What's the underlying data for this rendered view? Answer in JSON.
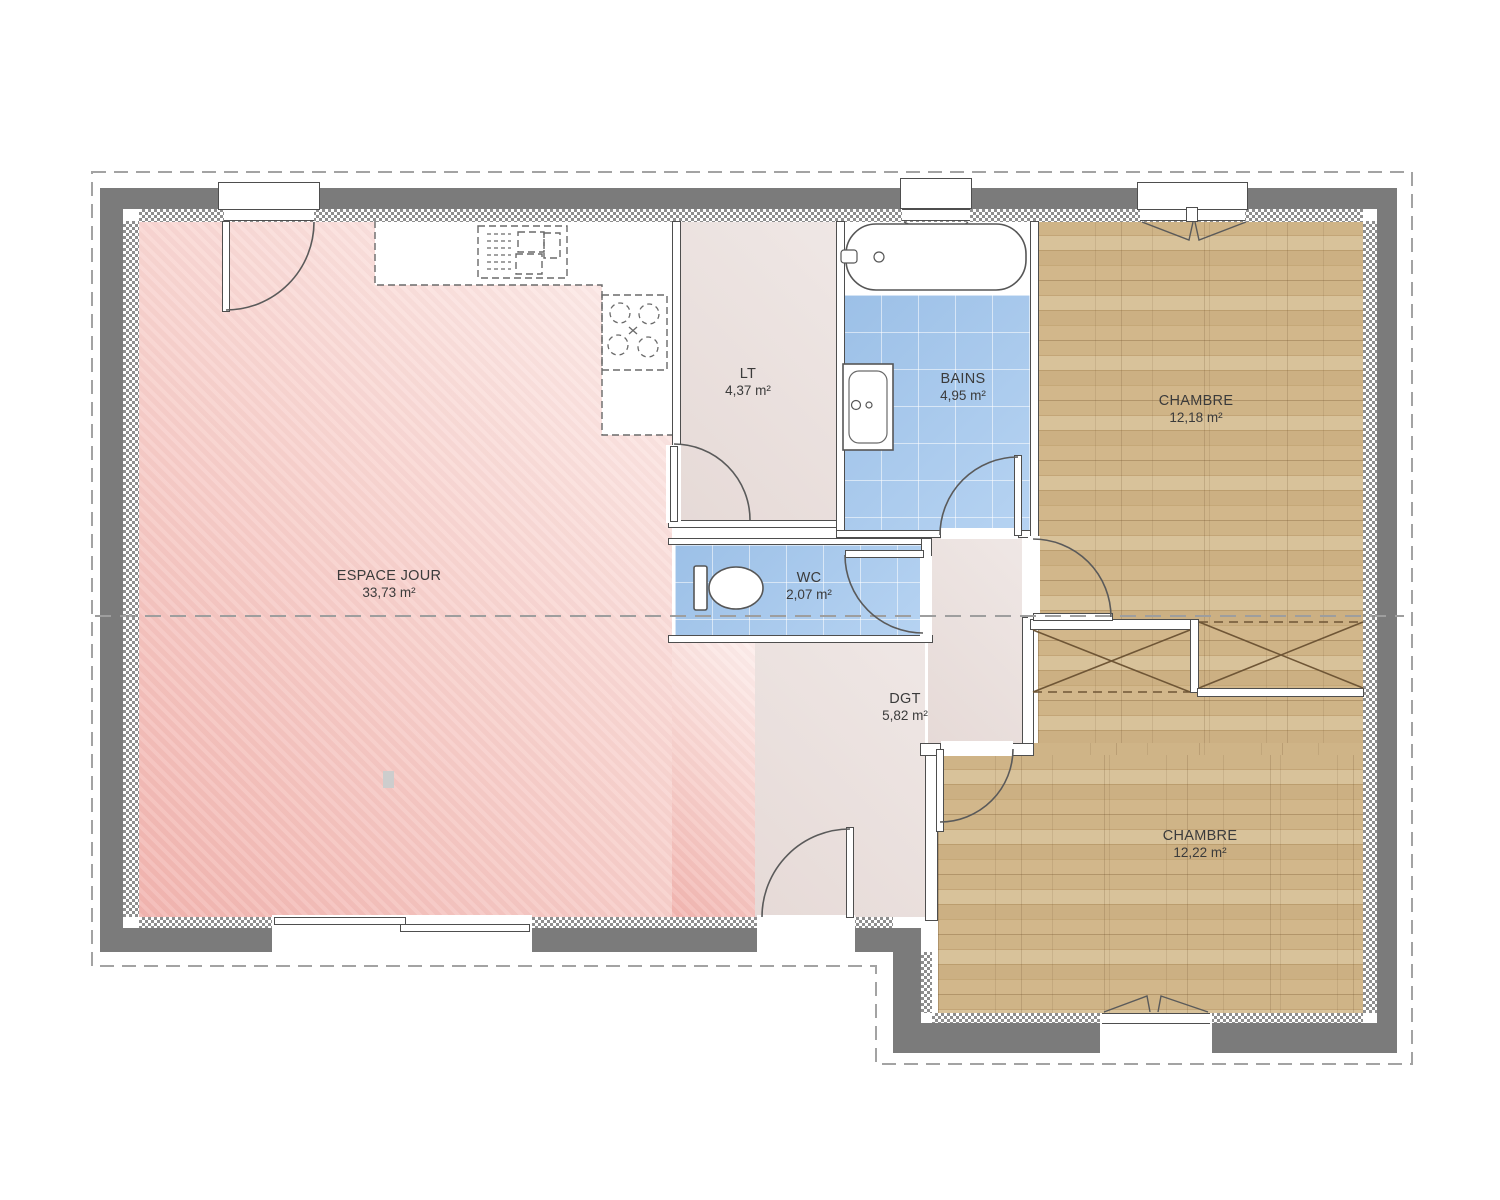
{
  "plan": {
    "kind": "house floor plan",
    "language": "fr"
  },
  "rooms": {
    "espace_jour": {
      "name": "ESPACE JOUR",
      "area": "33,73 m²"
    },
    "lt": {
      "name": "LT",
      "area": "4,37 m²"
    },
    "bains": {
      "name": "BAINS",
      "area": "4,95 m²"
    },
    "chambre_1": {
      "name": "CHAMBRE",
      "area": "12,18 m²"
    },
    "wc": {
      "name": "WC",
      "area": "2,07 m²"
    },
    "dgt": {
      "name": "DGT",
      "area": "5,82 m²"
    },
    "chambre_2": {
      "name": "CHAMBRE",
      "area": "12,22 m²"
    }
  },
  "palette": {
    "exterior_wall": "#7b7b7b",
    "living_pink": "#f5c2bd",
    "hall_beige": "#e9dfdd",
    "wet_room_blue": "#a9c9ec",
    "bedroom_wood": "#c9ad7f",
    "line_dark": "#4e4e4e",
    "dashed_gray": "#a3a3a3",
    "text": "#3b3b3b"
  }
}
